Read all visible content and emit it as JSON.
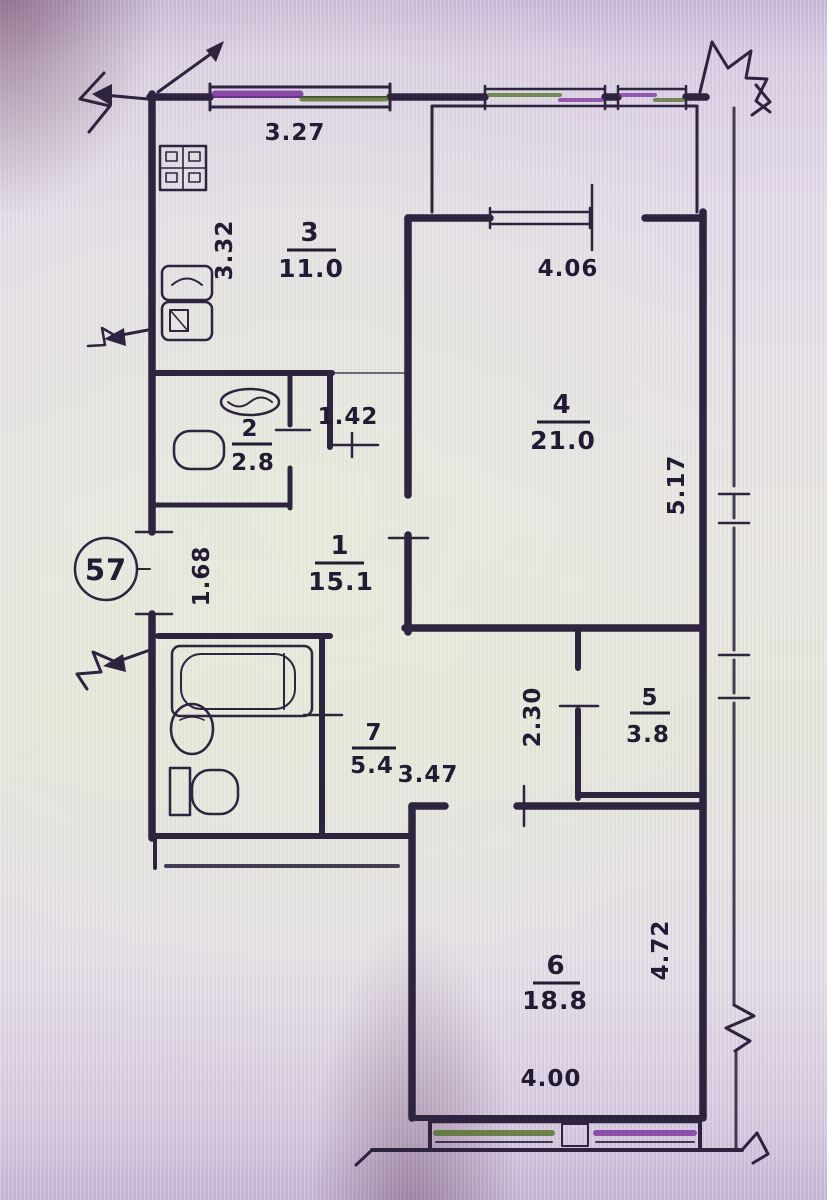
{
  "plan": {
    "unit_badge": "57",
    "rooms": {
      "kitchen": {
        "number": "3",
        "area": "11.0"
      },
      "living": {
        "number": "4",
        "area": "21.0"
      },
      "wc": {
        "number": "2",
        "area": "2.8"
      },
      "hall": {
        "number": "1",
        "area": "15.1"
      },
      "bath": {
        "number": "7",
        "area": "5.4"
      },
      "closet": {
        "number": "5",
        "area": "3.8"
      },
      "bedroom": {
        "number": "6",
        "area": "18.8"
      }
    },
    "dims": {
      "kitchen_w": "3.27",
      "kitchen_h": "3.32",
      "living_w": "4.06",
      "living_h": "5.17",
      "hall_opening": "1.42",
      "entry_w": "1.68",
      "hall_w": "3.47",
      "closet_h": "2.30",
      "bedroom_w": "4.00",
      "bedroom_h": "4.72"
    }
  }
}
